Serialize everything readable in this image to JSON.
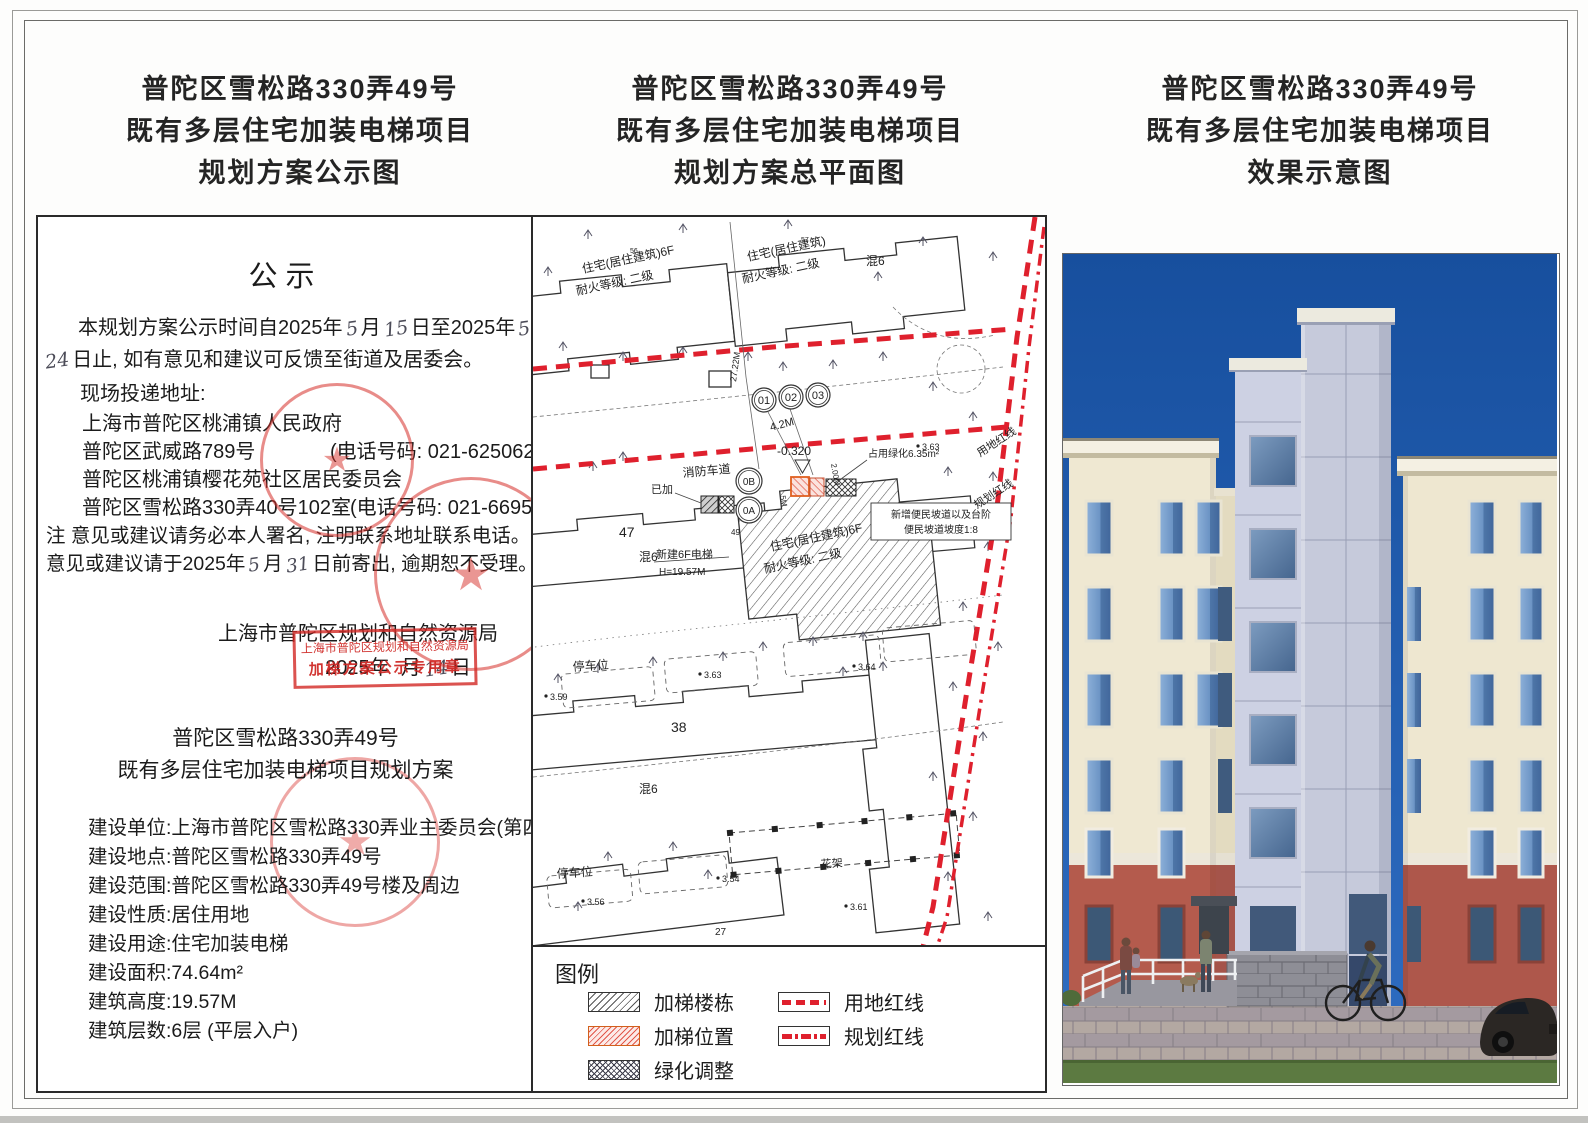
{
  "titles": [
    {
      "l1": "普陀区雪松路330弄49号",
      "l2": "既有多层住宅加装电梯项目",
      "l3": "规划方案公示图"
    },
    {
      "l1": "普陀区雪松路330弄49号",
      "l2": "既有多层住宅加装电梯项目",
      "l3": "规划方案总平面图"
    },
    {
      "l1": "普陀区雪松路330弄49号",
      "l2": "既有多层住宅加装电梯项目",
      "l3": "效果示意图"
    }
  ],
  "notice": {
    "heading": "公示",
    "line1_pre": "本规划方案公示时间自2025年",
    "hand_month1": "5",
    "line1_mid": "月",
    "hand_day1": "15",
    "line1_mid2": "日至2025年",
    "hand_month2": "5",
    "line1_end": "月",
    "hand_day2": "24",
    "line2": "日止, 如有意见和建议可反馈至街道及居委会。",
    "line3": "现场投递地址:",
    "line4": "上海市普陀区桃浦镇人民政府",
    "line5": "普陀区武威路789号",
    "line5_phone": "(电话号码: 021-62506213)",
    "line6": "普陀区桃浦镇樱花苑社区居民委员会",
    "line7": "普陀区雪松路330弄40号102室",
    "line7_phone": "(电话号码: 021-66951786)",
    "line8": "注 意见或建议请务必本人署名, 注明联系地址联系电话。",
    "line9_pre": "意见或建议请于2025年",
    "hand_month3": "5",
    "line9_mid": "月",
    "hand_day3": "31",
    "line9_end": "日前寄出, 逾期恕不受理。",
    "authority": "上海市普陀区规划和自然资源局",
    "date_pre": "2025年",
    "date_mid": "月",
    "hand_day4": "14",
    "date_end": "日",
    "stamp_line1": "上海市普陀区规划和自然资源局",
    "stamp_line2": "加梯方案公示专用章",
    "star": "★"
  },
  "project": {
    "t1": "普陀区雪松路330弄49号",
    "t2": "既有多层住宅加装电梯项目规划方案",
    "rows": [
      {
        "label": "建设单位:",
        "value": "上海市普陀区雪松路330弄业主委员会(第四届)"
      },
      {
        "label": "建设地点:",
        "value": "普陀区雪松路330弄49号"
      },
      {
        "label": "建设范围:",
        "value": "普陀区雪松路330弄49号楼及周边"
      },
      {
        "label": "建设性质:",
        "value": "居住用地"
      },
      {
        "label": "建设用途:",
        "value": "住宅加装电梯"
      },
      {
        "label": "建设面积:",
        "value": "74.64m²"
      },
      {
        "label": "建筑高度:",
        "value": "19.57M"
      },
      {
        "label": "建筑层数:",
        "value": "6层 (平层入户)"
      }
    ]
  },
  "map": {
    "bldg_tl_no": "56",
    "bldg_tl_1": "住宅(居住建筑)6F",
    "bldg_tl_2": "耐火等级: 二级",
    "bldg_tr_no": "57",
    "bldg_tr_1": "住宅(居住建筑)",
    "bldg_tr_2": "耐火等级: 二级",
    "hun6_a": "混6",
    "hun6_b": "混6",
    "hun6_c": "混6",
    "dim_2722": "27.22M",
    "dim_42": "4.2M",
    "dim_5": "5M",
    "dim_200": "2.00M",
    "c01": "01",
    "c02": "02",
    "c03": "03",
    "c0b": "0B",
    "c0a": "0A",
    "elev": "-0.320",
    "fire_lane": "消防车道",
    "already": "已加",
    "green": "占用绿化6.35m²",
    "spot_a": "3.63",
    "spot_b": "3.63",
    "spot_c": "3.59",
    "spot_d": "3.64",
    "spot_e": "3.56",
    "spot_f": "3.54",
    "spot_g": "3.61",
    "land_line": "用地红线",
    "plan_line": "规划红线",
    "ramp1": "新增便民坡道以及台阶",
    "ramp2": "便民坡道坡度1:8",
    "n47": "47",
    "n49": "49",
    "n38": "38",
    "n27": "27",
    "new_elev1": "新建6F电梯",
    "new_elev2": "H=19.57M",
    "bldg_m_1": "住宅(居住建筑)6F",
    "bldg_m_2": "耐火等级: 二级",
    "parking1": "停车位",
    "parking2": "停车位",
    "flower": "花架"
  },
  "legend": {
    "title": "图例",
    "items": [
      {
        "label": "加梯楼栋"
      },
      {
        "label": "加梯位置"
      },
      {
        "label": "绿化调整"
      },
      {
        "label": "用地红线"
      },
      {
        "label": "规划红线"
      }
    ]
  },
  "colors": {
    "stamp_red": "#d62d28",
    "map_red": "#df202d",
    "sky_blue": "#1d55a9",
    "facade_cream": "#efe8d2",
    "lower_terracotta": "#b45b4d",
    "tower_gray": "#c9cde0"
  }
}
